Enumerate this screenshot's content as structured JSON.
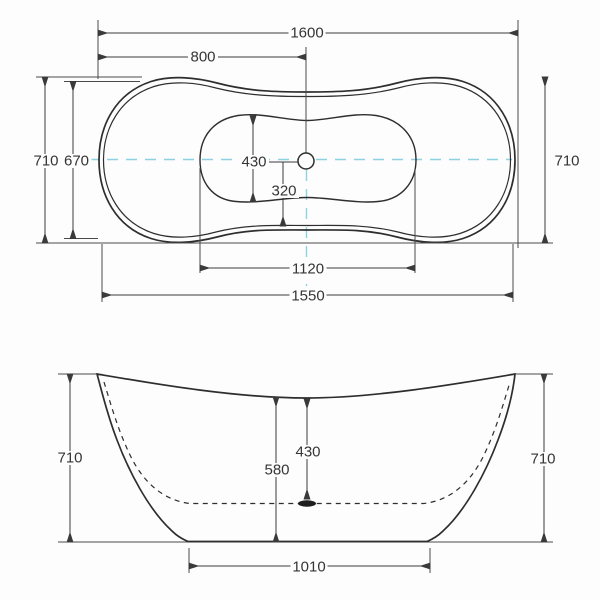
{
  "document": {
    "type": "bathtub technical drawing, plan and front elevation with dimensions"
  },
  "colors": {
    "line": "#3a3a3a",
    "centerline": "#8ed2e2",
    "background": "#fdfdfd"
  },
  "top_view": {
    "overall_length": "1600",
    "half_length": "800",
    "overall_width_left": "710",
    "inner_width_left": "670",
    "overall_width_right": "710",
    "basin_width": "430",
    "drain_offset": "320",
    "basin_length": "1120",
    "rim_length": "1550"
  },
  "front_view": {
    "height_left": "710",
    "height_right": "710",
    "inner_depth": "580",
    "drain_depth": "430",
    "base_length": "1010"
  }
}
